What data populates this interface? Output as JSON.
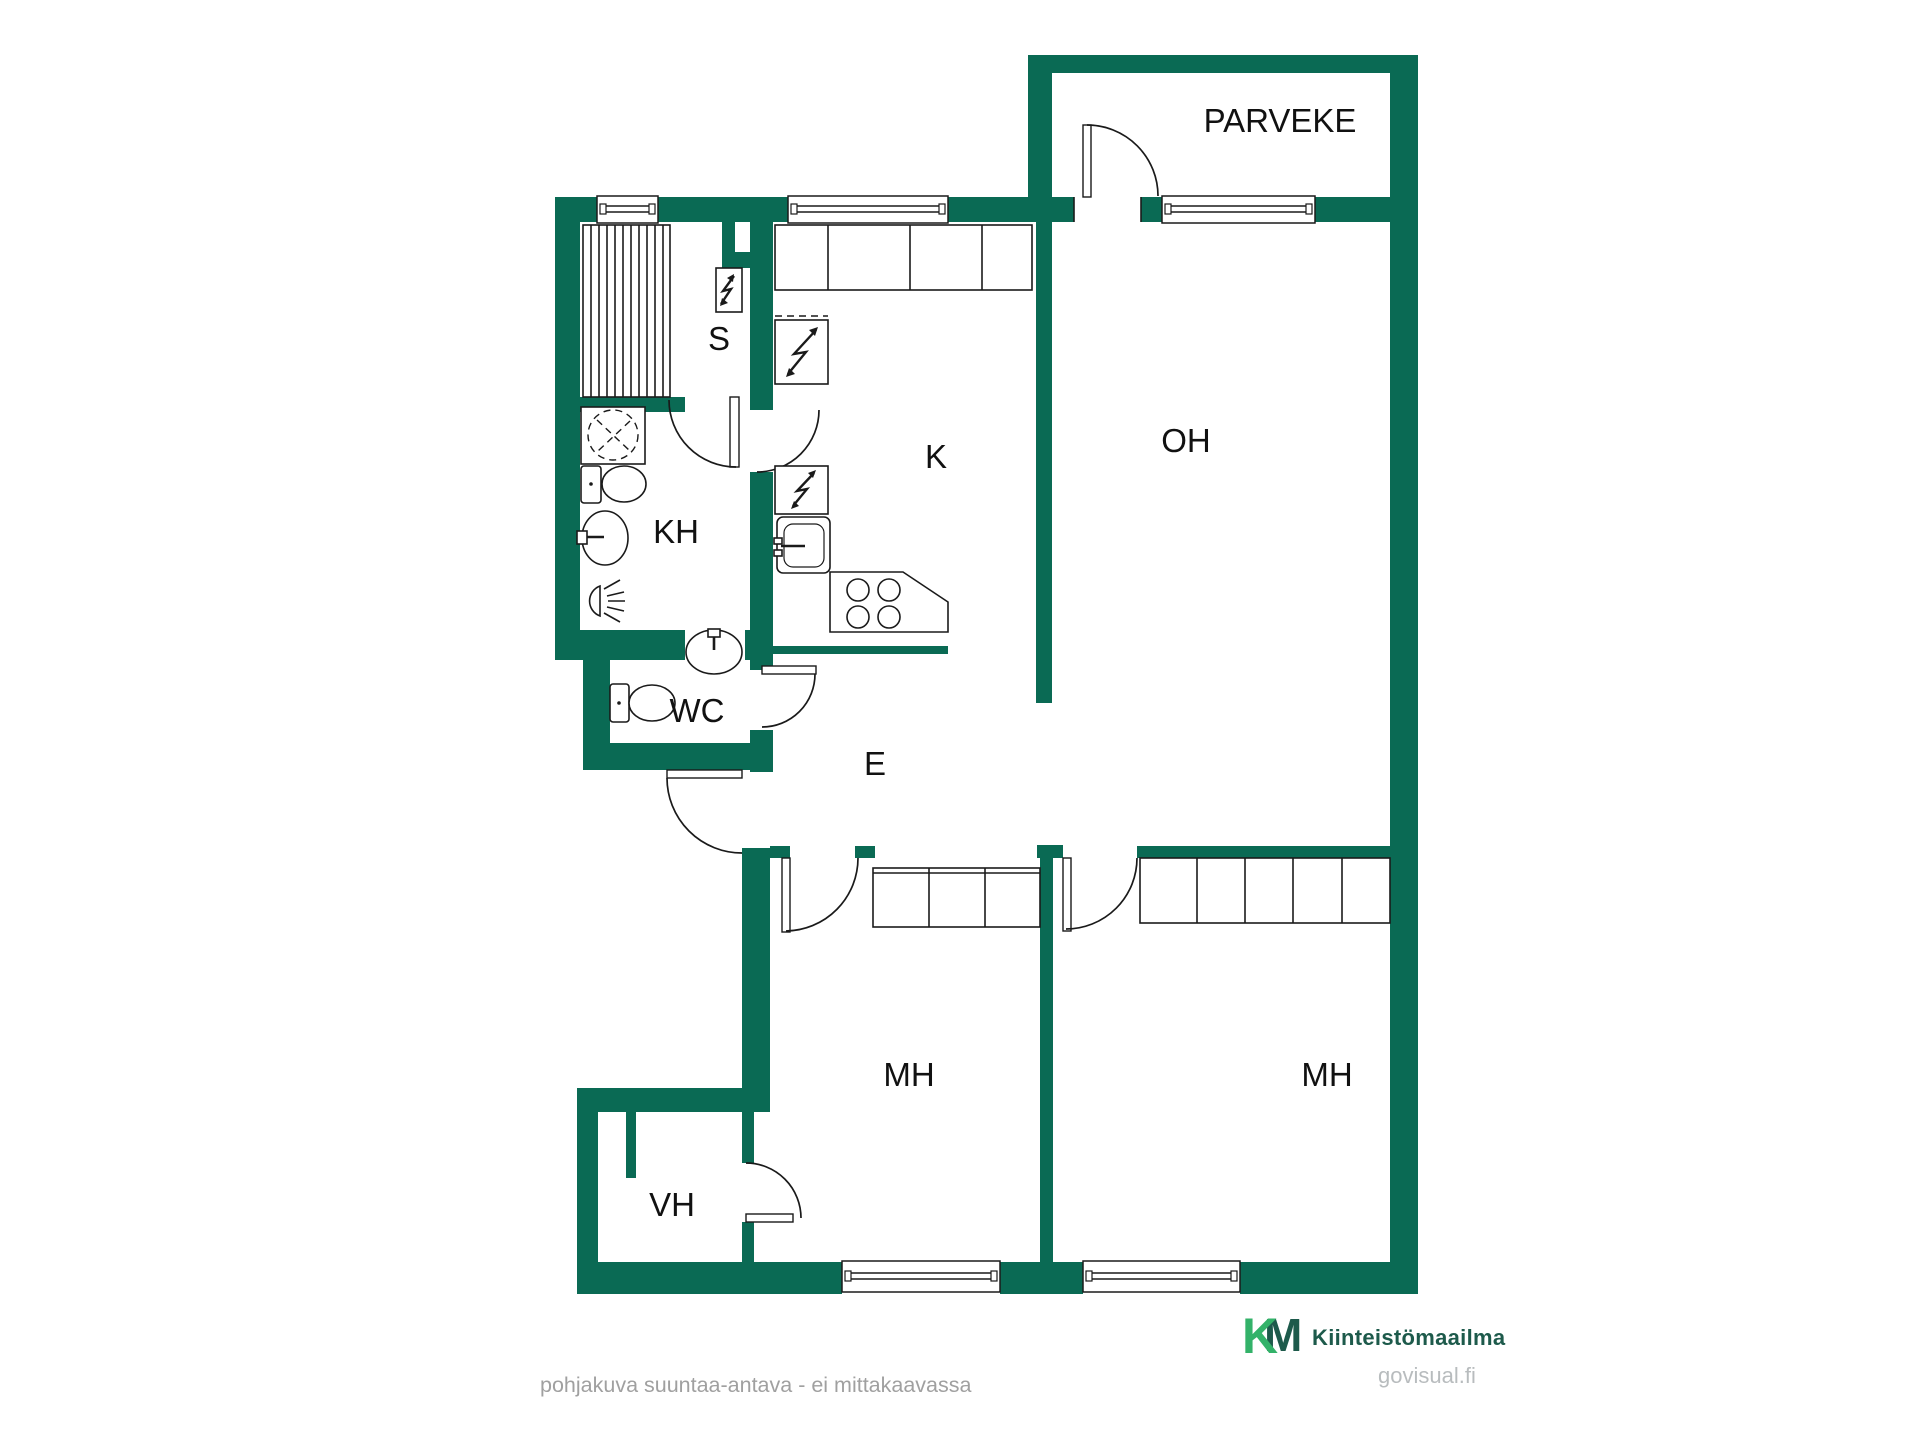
{
  "colors": {
    "wall": "#0a6a54",
    "ink": "#1a1a1a",
    "label": "#111111",
    "disclaimer": "#a0a0a0",
    "brand-k": "#33b269",
    "brand-dark": "#1d5a4b",
    "website": "#b8bcbe"
  },
  "floorplan": {
    "wall_color": "#0a6a54",
    "rooms": [
      {
        "id": "parveke",
        "label": "PARVEKE"
      },
      {
        "id": "sauna",
        "label": "S"
      },
      {
        "id": "kylpyhuone",
        "label": "KH"
      },
      {
        "id": "keittio",
        "label": "K"
      },
      {
        "id": "olohuone",
        "label": "OH"
      },
      {
        "id": "wc",
        "label": "WC"
      },
      {
        "id": "eteinen",
        "label": "E"
      },
      {
        "id": "makuuhuone-1",
        "label": "MH"
      },
      {
        "id": "makuuhuone-2",
        "label": "MH"
      },
      {
        "id": "vaatehuone",
        "label": "VH"
      }
    ],
    "icons": {
      "sauna-bench-icon": "striped bench",
      "shower-icon": "dashed circle in square",
      "toilet-icon": "tank + bowl",
      "sink-icon": "oval basin",
      "stove-icon": "4 burner circles",
      "electrical-symbol": "lightning zigzag",
      "wardrobe-row": "divided cabinet boxes",
      "window": "double-line wall opening",
      "door-swing": "quarter-circle arc"
    }
  },
  "footer": {
    "disclaimer": "pohjakuva suuntaa-antava - ei mittakaavassa",
    "brand_k": "K",
    "brand_m": "M",
    "brand_name": "Kiinteistömaailma",
    "website": "govisual.fi"
  }
}
